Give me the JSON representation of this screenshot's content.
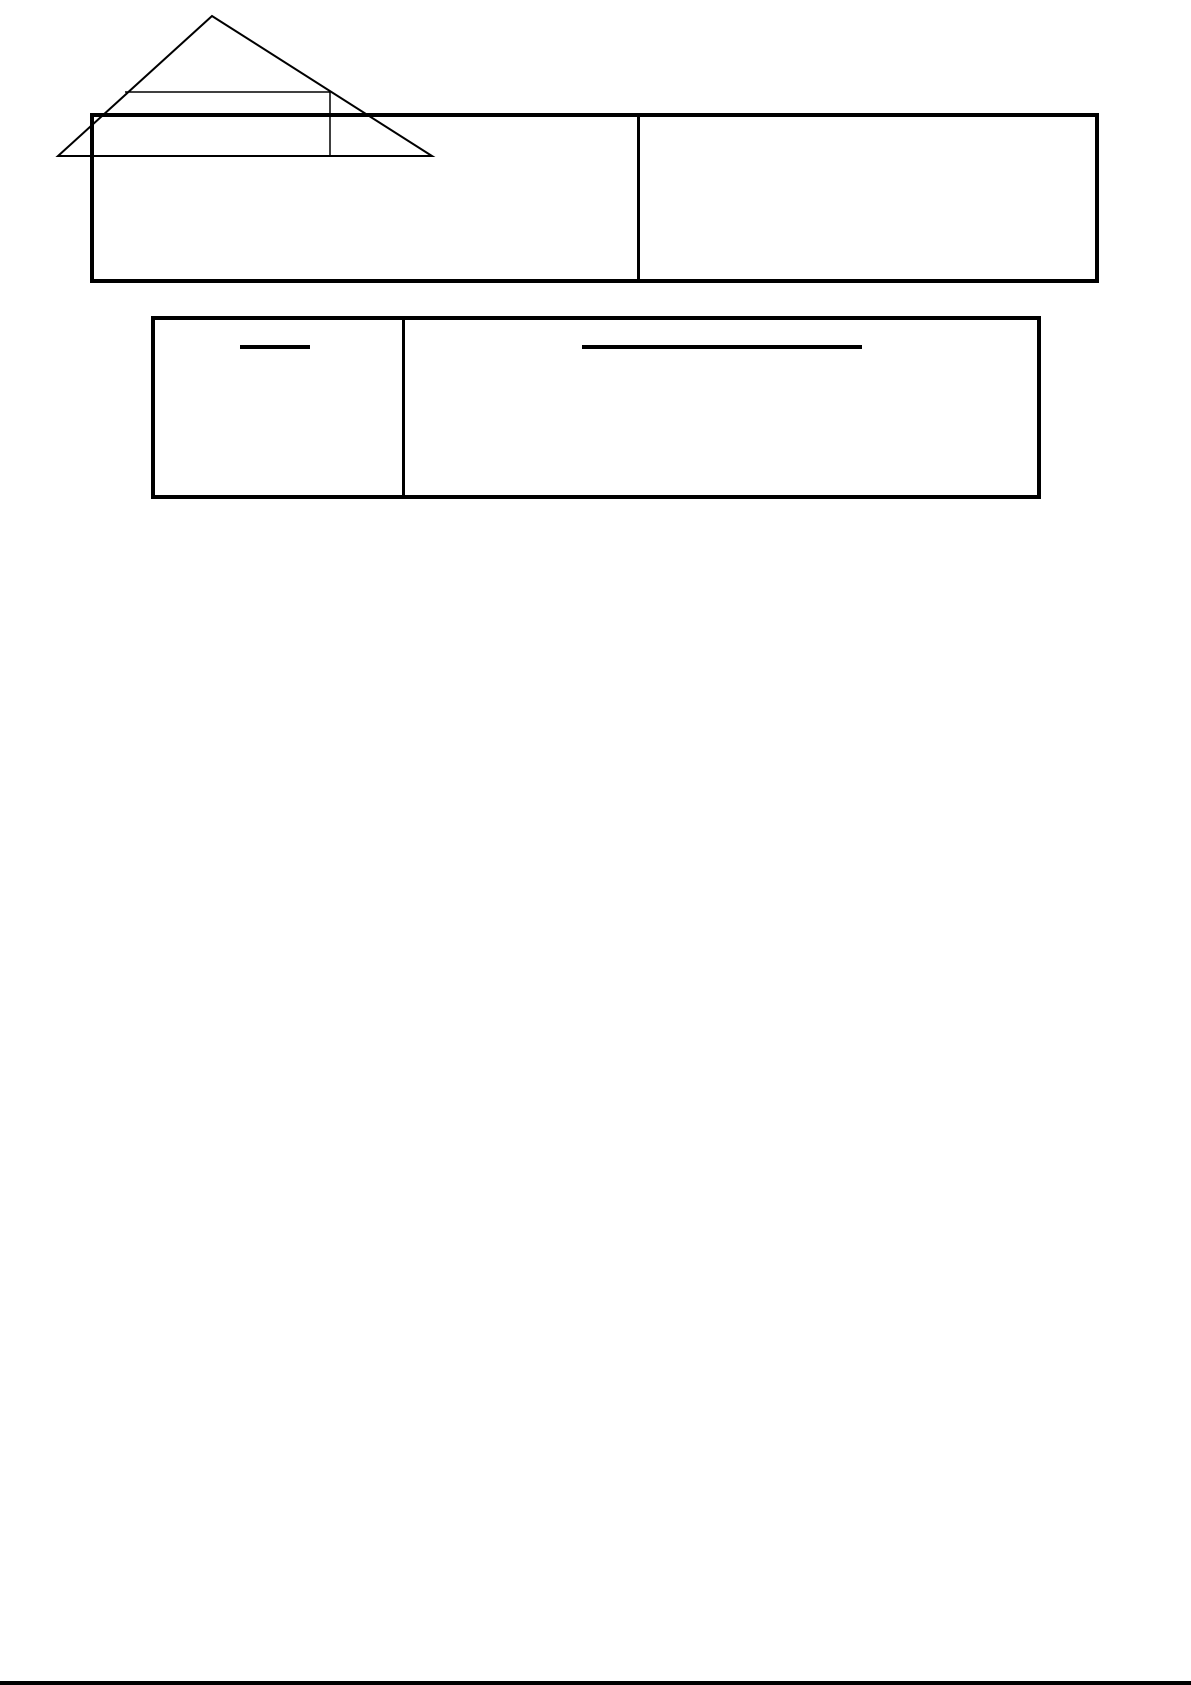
{
  "page": {
    "width": 1191,
    "height": 1685,
    "background_color": "#ffffff",
    "ink_color": "#000000"
  },
  "top_table": {
    "rows": 1,
    "columns": 2,
    "cells": [
      "",
      ""
    ],
    "geometry": {
      "left": 90,
      "top": 113,
      "width": 1009,
      "height": 170
    },
    "left_cell": {
      "left": 0,
      "top": 0,
      "width": 543,
      "height": 162
    },
    "divider": {
      "left": 543,
      "top": 0,
      "width": 3,
      "height": 162
    },
    "right_cell": {
      "left": 546,
      "top": 0,
      "width": 455,
      "height": 162
    }
  },
  "second_table": {
    "rows": 1,
    "columns": 2,
    "cells": [
      "",
      ""
    ],
    "geometry": {
      "left": 151,
      "top": 316,
      "width": 890,
      "height": 183
    },
    "left_cell": {
      "left": 0,
      "top": 0,
      "width": 247,
      "height": 175
    },
    "divider": {
      "left": 247,
      "top": 0,
      "width": 3,
      "height": 175
    },
    "right_cell": {
      "left": 250,
      "top": 0,
      "width": 632,
      "height": 175
    },
    "answer_blanks": [
      {
        "cell": "left",
        "geometry": {
          "left": 85,
          "top": 25,
          "width": 70,
          "height": 4
        }
      },
      {
        "cell": "right",
        "geometry": {
          "left": 427,
          "top": 25,
          "width": 280,
          "height": 4
        }
      }
    ]
  },
  "figure": {
    "type": "divided-triangle",
    "geometry": {
      "left": 650,
      "top": 1490,
      "width": 460,
      "height": 170
    },
    "outline_points": "212,16 58,156 432,156",
    "outline_stroke_width": 2,
    "inner_horizontal_line": {
      "x1": 125,
      "y1": 92,
      "x2": 330,
      "y2": 92
    },
    "inner_vertical_line": {
      "x1": 330,
      "y1": 92,
      "x2": 330,
      "y2": 156
    },
    "inner_stroke_width": 1.5
  },
  "bottom_bar": {
    "geometry": {
      "left": 0,
      "top": 1681,
      "width": 1191,
      "height": 4
    },
    "color": "#000000"
  }
}
